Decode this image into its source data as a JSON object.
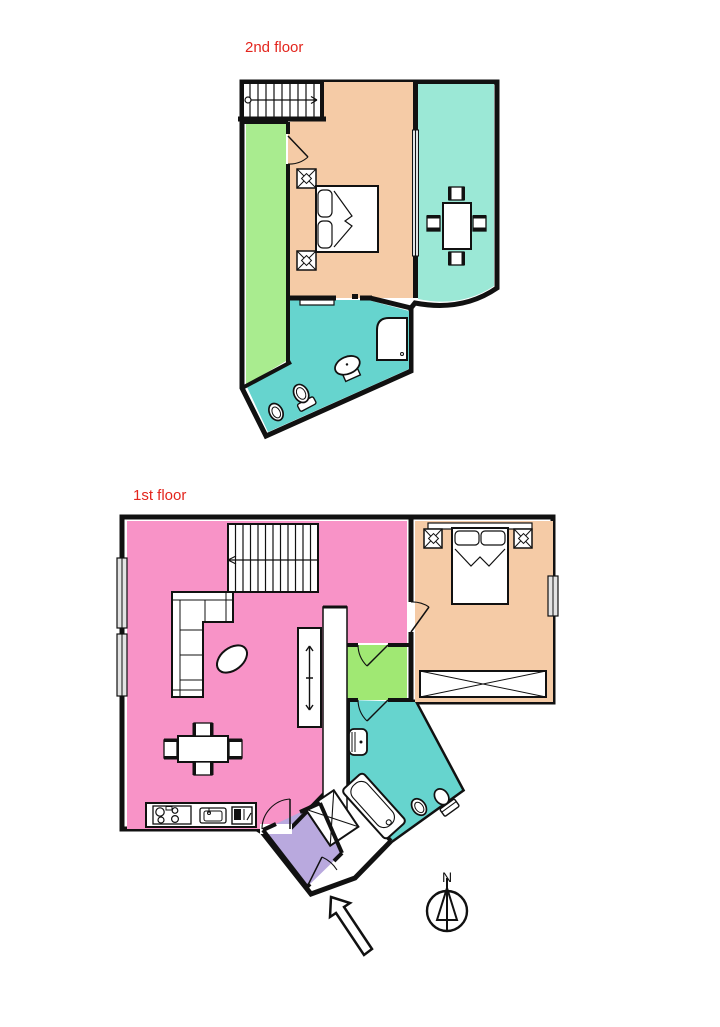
{
  "labels": {
    "floor2": "2nd floor",
    "floor1": "1st floor",
    "compass_north": "N"
  },
  "colors": {
    "background": "#ffffff",
    "wall": "#111111",
    "label_red": "#e3251d",
    "living_pink": "#f893c7",
    "bedroom_peach": "#f5cba6",
    "terrace_green": "#a9ec8f",
    "vestibule_green": "#a0e873",
    "bathroom_teal": "#66d4ce",
    "dining_mint": "#9be8d6",
    "entry_purple": "#b9a9de",
    "window_gray": "#e3e3e3"
  }
}
